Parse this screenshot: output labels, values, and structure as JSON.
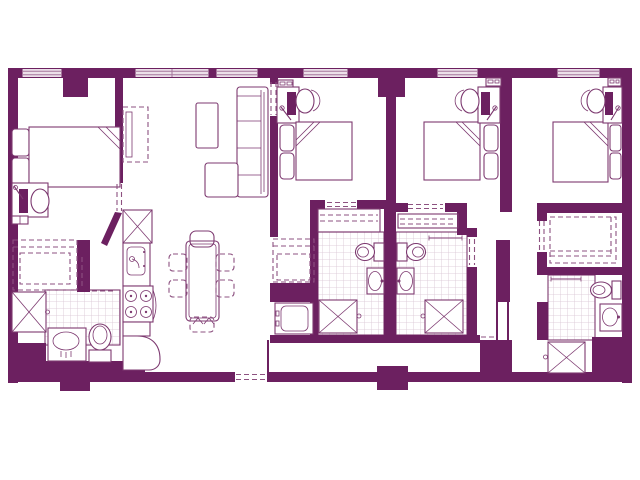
{
  "colors": {
    "wall": "#6c2060",
    "line": "#7d3970",
    "dash": "#8d5180",
    "tile": "#d8c3d2",
    "window_fill": "#ecdfe9",
    "window_line": "#a5769c",
    "background": "#ffffff"
  },
  "floor_plan": {
    "type": "apartment-floor-plan",
    "drawing_style": "2D architectural line drawing, plum purple on white, no text labels",
    "window_count": 6,
    "rooms": [
      {
        "id": "bedroom-1",
        "position": "top-left",
        "items": [
          "double-bed",
          "pillows",
          "desk",
          "desk-chair",
          "laptop",
          "desk-lamp",
          "shelf",
          "wardrobe-closet",
          "door"
        ]
      },
      {
        "id": "kitchen",
        "position": "center-left",
        "items": [
          "refrigerator",
          "tall-cabinet",
          "kitchen-sink",
          "range-4-burner",
          "dishwasher",
          "counter"
        ]
      },
      {
        "id": "dining-area",
        "position": "center",
        "items": [
          "dining-table",
          "dining-chair",
          "dining-chair",
          "dining-chair",
          "dining-chair",
          "dining-chair",
          "dining-chair"
        ]
      },
      {
        "id": "living-area",
        "position": "top-center",
        "items": [
          "sectional-sofa",
          "chaise",
          "coffee-table"
        ]
      },
      {
        "id": "bedroom-2",
        "position": "center",
        "items": [
          "double-bed",
          "nightstand",
          "nightstand",
          "desk",
          "desk-chair",
          "laptop",
          "desk-lamp",
          "shelf",
          "closet",
          "door"
        ]
      },
      {
        "id": "bedroom-3",
        "position": "center-right",
        "items": [
          "double-bed",
          "nightstand",
          "nightstand",
          "desk",
          "desk-chair",
          "laptop",
          "desk-lamp",
          "shelf",
          "closet",
          "door"
        ]
      },
      {
        "id": "bedroom-4",
        "position": "top-right",
        "items": [
          "double-bed",
          "nightstand",
          "nightstand",
          "desk",
          "desk-chair",
          "laptop",
          "desk-lamp",
          "shelf",
          "wardrobe-closet",
          "door"
        ]
      },
      {
        "id": "bathroom-1",
        "position": "bottom-left",
        "items": [
          "shower-stall",
          "vanity-sink",
          "toilet",
          "tiled-floor"
        ]
      },
      {
        "id": "bathroom-2",
        "position": "center-bottom-left",
        "items": [
          "shower-stall",
          "vanity-sink",
          "toilet",
          "tiled-floor"
        ]
      },
      {
        "id": "bathroom-3",
        "position": "center-bottom-right",
        "items": [
          "shower-stall",
          "vanity-sink",
          "toilet",
          "towel-bar",
          "tiled-floor"
        ]
      },
      {
        "id": "bathroom-4",
        "position": "bottom-right",
        "items": [
          "shower-stall",
          "vanity-sink",
          "toilet",
          "towel-bar",
          "tiled-floor"
        ]
      },
      {
        "id": "laundry-closet",
        "position": "center",
        "items": [
          "washer",
          "storage-closet"
        ]
      },
      {
        "id": "entry",
        "position": "bottom-left",
        "items": [
          "entry-door-opening"
        ]
      },
      {
        "id": "hallway",
        "position": "bottom",
        "items": []
      }
    ]
  }
}
